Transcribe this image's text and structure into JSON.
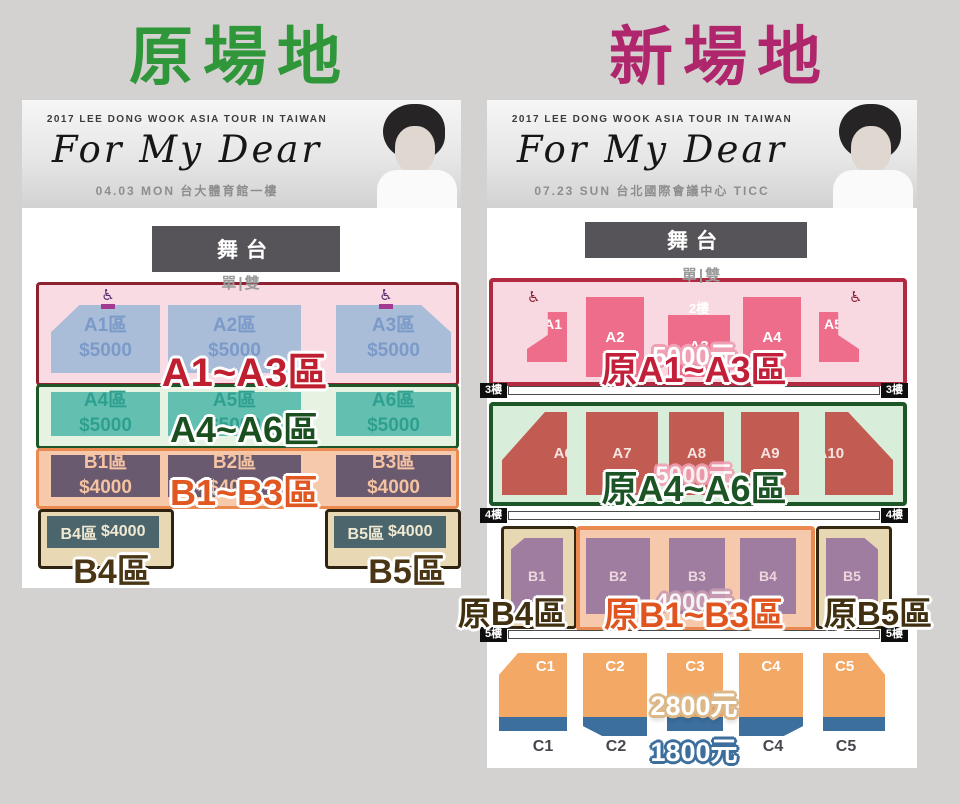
{
  "titles": {
    "left": "原場地",
    "right": "新場地"
  },
  "banner": {
    "tour": "2017 LEE DONG WOOK ASIA TOUR IN TAIWAN",
    "title": "For My Dear",
    "left_info": "04.03 MON 台大體育館一樓",
    "right_info": "07.23 SUN 台北國際會議中心 TICC"
  },
  "icons": {
    "wheelchair": "♿"
  },
  "colors": {
    "left_title_green": "#2f9639",
    "right_title_magenta": "#b0266c",
    "tier_a_red_border": "#8e2130",
    "tier_a_blue_seat": "#a9bdd9",
    "teal_seat": "#63c0b0",
    "mauve_seat": "#9e7da1",
    "brick_seat": "#c25b51",
    "rose_seat": "#ed6d8b",
    "orange_seat": "#f3a965",
    "blue_strip": "#3c6f9e"
  },
  "left_chart": {
    "stage": "舞台",
    "aisle": "單|雙",
    "tier_a": {
      "overlay": "A1~A3區",
      "sections": [
        {
          "name": "A1區",
          "price": "$5000"
        },
        {
          "name": "A2區",
          "price": "$5000"
        },
        {
          "name": "A3區",
          "price": "$5000"
        }
      ]
    },
    "tier_a2": {
      "overlay": "A4~A6區",
      "sections": [
        {
          "name": "A4區",
          "price": "$5000"
        },
        {
          "name": "A5區",
          "price": "$5000"
        },
        {
          "name": "A6區",
          "price": "$5000"
        }
      ]
    },
    "tier_b": {
      "overlay": "B1~B3區",
      "sections": [
        {
          "name": "B1區",
          "price": "$4000"
        },
        {
          "name": "B2區",
          "price": "$4000"
        },
        {
          "name": "B3區",
          "price": "$4000"
        }
      ]
    },
    "tier_b4": {
      "name": "B4區",
      "price": "$4000",
      "overlay": "B4區"
    },
    "tier_b5": {
      "name": "B5區",
      "price": "$4000",
      "overlay": "B5區"
    }
  },
  "right_chart": {
    "stage": "舞台",
    "aisle": "單|雙",
    "floor2": "2樓",
    "floors": {
      "f3": "3樓",
      "f4": "4樓",
      "f5": "5樓"
    },
    "tier_2f": {
      "overlay": "原A1~A3區",
      "price": "5000元",
      "sections": [
        "A1",
        "A2",
        "A3",
        "A4",
        "A5"
      ]
    },
    "tier_3f": {
      "overlay": "原A4~A6區",
      "price": "5000元",
      "sections": [
        "A6",
        "A7",
        "A8",
        "A9",
        "A10"
      ]
    },
    "tier_4f": {
      "overlay_left": "原B4區",
      "overlay_center": "原B1~B3區",
      "overlay_right": "原B5區",
      "price": "4000元",
      "sections": [
        "B1",
        "B2",
        "B3",
        "B4",
        "B5"
      ]
    },
    "tier_5f": {
      "price_upper": "2800元",
      "price_lower": "1800元",
      "sections": [
        "C1",
        "C2",
        "C3",
        "C4",
        "C5"
      ],
      "labels": [
        "C1",
        "C2",
        "C4",
        "C5"
      ]
    }
  }
}
